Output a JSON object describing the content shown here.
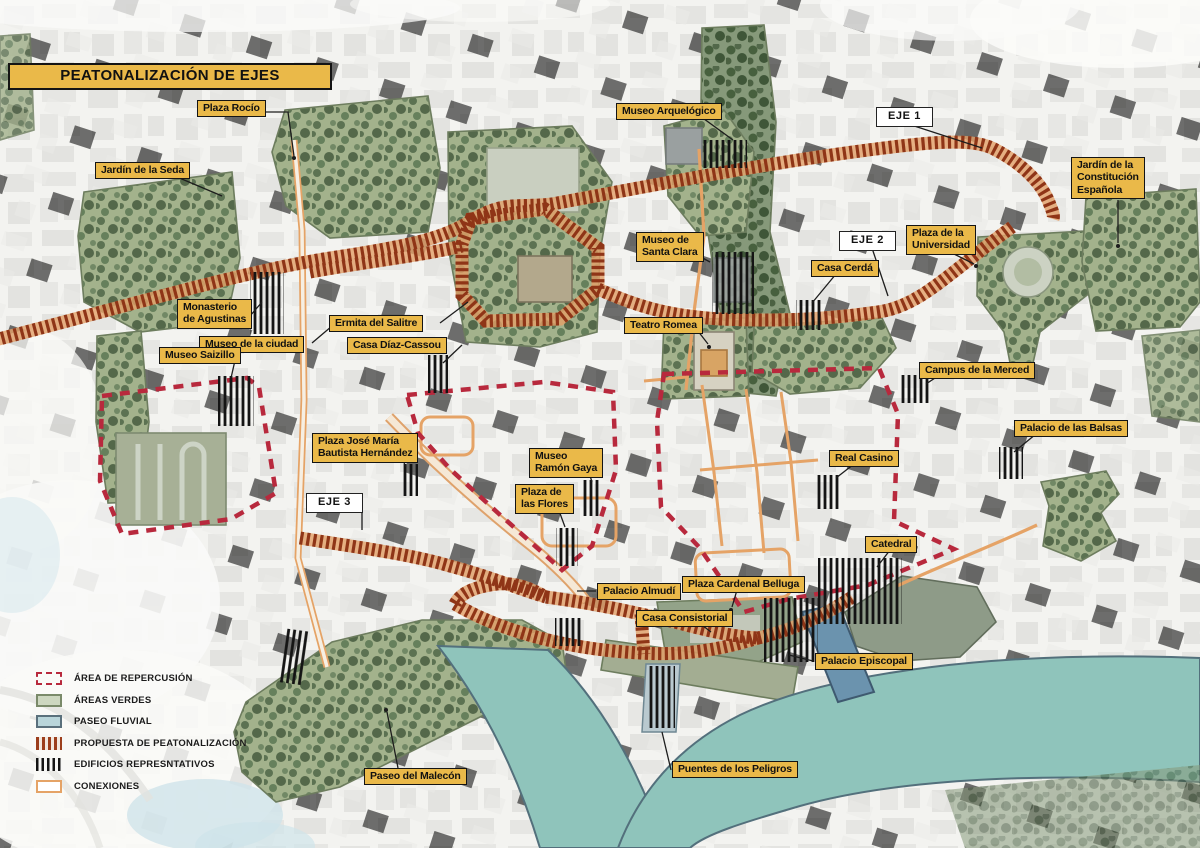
{
  "title": "PEATONALIZACIÓN DE EJES",
  "colors": {
    "label_yellow": "#EAB949",
    "hatch_red": "#8F3517",
    "hatch_underlay": "#E3A068",
    "impact_red": "#B8293D",
    "connection_orange": "#E5A366",
    "green_area": "#A3B28C",
    "river_teal": "#8FC4BB",
    "building_black": "#141414"
  },
  "place_labels": [
    {
      "id": "plaza-rocio",
      "text": "Plaza Rocío",
      "x": 197,
      "y": 100,
      "kind": "place"
    },
    {
      "id": "jardin-de-la-seda",
      "text": "Jardín de la Seda",
      "x": 95,
      "y": 162,
      "kind": "place"
    },
    {
      "id": "museo-arquelogico",
      "text": "Museo Arquelógico",
      "x": 616,
      "y": 103,
      "kind": "place"
    },
    {
      "id": "eje-1",
      "text": "EJE 1",
      "x": 876,
      "y": 107,
      "kind": "eje"
    },
    {
      "id": "jardin-constitucion",
      "text": "Jardín de la\nConstitución\nEspañola",
      "x": 1071,
      "y": 157,
      "kind": "place"
    },
    {
      "id": "museo-santa-clara",
      "text": "Museo de\nSanta Clara",
      "x": 636,
      "y": 232,
      "kind": "place"
    },
    {
      "id": "eje-2",
      "text": "EJE 2",
      "x": 839,
      "y": 231,
      "kind": "eje"
    },
    {
      "id": "plaza-universidad",
      "text": "Plaza de la\nUniversidad",
      "x": 906,
      "y": 225,
      "kind": "place"
    },
    {
      "id": "casa-cerda",
      "text": "Casa Cerdá",
      "x": 811,
      "y": 260,
      "kind": "place"
    },
    {
      "id": "monasterio-agustinas",
      "text": "Monasterio\nde Agustinas",
      "x": 177,
      "y": 299,
      "kind": "place"
    },
    {
      "id": "ermita-salitre",
      "text": "Ermita del Salitre",
      "x": 329,
      "y": 315,
      "kind": "place"
    },
    {
      "id": "museo-ciudad",
      "text": "Museo de la ciudad",
      "x": 199,
      "y": 336,
      "kind": "place"
    },
    {
      "id": "casa-diaz-cassou",
      "text": "Casa Díaz-Cassou",
      "x": 347,
      "y": 337,
      "kind": "place"
    },
    {
      "id": "teatro-romea",
      "text": "Teatro Romea",
      "x": 624,
      "y": 317,
      "kind": "place"
    },
    {
      "id": "museo-saizillo",
      "text": "Museo Saizillo",
      "x": 159,
      "y": 347,
      "kind": "place"
    },
    {
      "id": "campus-merced",
      "text": "Campus de la Merced",
      "x": 919,
      "y": 362,
      "kind": "place"
    },
    {
      "id": "palacio-balsas",
      "text": "Palacio de las Balsas",
      "x": 1014,
      "y": 420,
      "kind": "place"
    },
    {
      "id": "plaza-jose-maria",
      "text": "Plaza José María\nBautista Hernández",
      "x": 312,
      "y": 433,
      "kind": "place"
    },
    {
      "id": "museo-ramon-gaya",
      "text": "Museo\nRamón Gaya",
      "x": 529,
      "y": 448,
      "kind": "place"
    },
    {
      "id": "real-casino",
      "text": "Real Casino",
      "x": 829,
      "y": 450,
      "kind": "place"
    },
    {
      "id": "plaza-flores",
      "text": "Plaza de\nlas Flores",
      "x": 515,
      "y": 484,
      "kind": "place"
    },
    {
      "id": "eje-3",
      "text": "EJE 3",
      "x": 306,
      "y": 493,
      "kind": "eje"
    },
    {
      "id": "catedral",
      "text": "Catedral",
      "x": 865,
      "y": 536,
      "kind": "place"
    },
    {
      "id": "palacio-almudi",
      "text": "Palacio Almudí",
      "x": 597,
      "y": 583,
      "kind": "place"
    },
    {
      "id": "plaza-belluga",
      "text": "Plaza Cardenal Belluga",
      "x": 682,
      "y": 576,
      "kind": "place"
    },
    {
      "id": "casa-consistorial",
      "text": "Casa Consistorial",
      "x": 636,
      "y": 610,
      "kind": "place"
    },
    {
      "id": "palacio-episcopal",
      "text": "Palacio Episcopal",
      "x": 815,
      "y": 653,
      "kind": "place"
    },
    {
      "id": "paseo-malecon",
      "text": "Paseo del Malecón",
      "x": 364,
      "y": 768,
      "kind": "place"
    },
    {
      "id": "puentes-peligros",
      "text": "Puentes de los Peligros",
      "x": 672,
      "y": 761,
      "kind": "place"
    }
  ],
  "legend": {
    "items": [
      {
        "id": "area-repercusion",
        "label": "ÁREA DE REPERCUSIÓN",
        "swatch": "repercusion"
      },
      {
        "id": "areas-verdes",
        "label": "ÁREAS VERDES",
        "swatch": "verdes"
      },
      {
        "id": "paseo-fluvial",
        "label": "PASEO FLUVIAL",
        "swatch": "fluvial"
      },
      {
        "id": "propuesta-peatonalizacion",
        "label": "PROPUESTA DE PEATONALIZACIÓN",
        "swatch": "propuesta"
      },
      {
        "id": "edificios-representativos",
        "label": "EDIFICIOS REPRESNTATIVOS",
        "swatch": "edificios"
      },
      {
        "id": "conexiones",
        "label": "CONEXIONES",
        "swatch": "conexiones"
      }
    ]
  }
}
